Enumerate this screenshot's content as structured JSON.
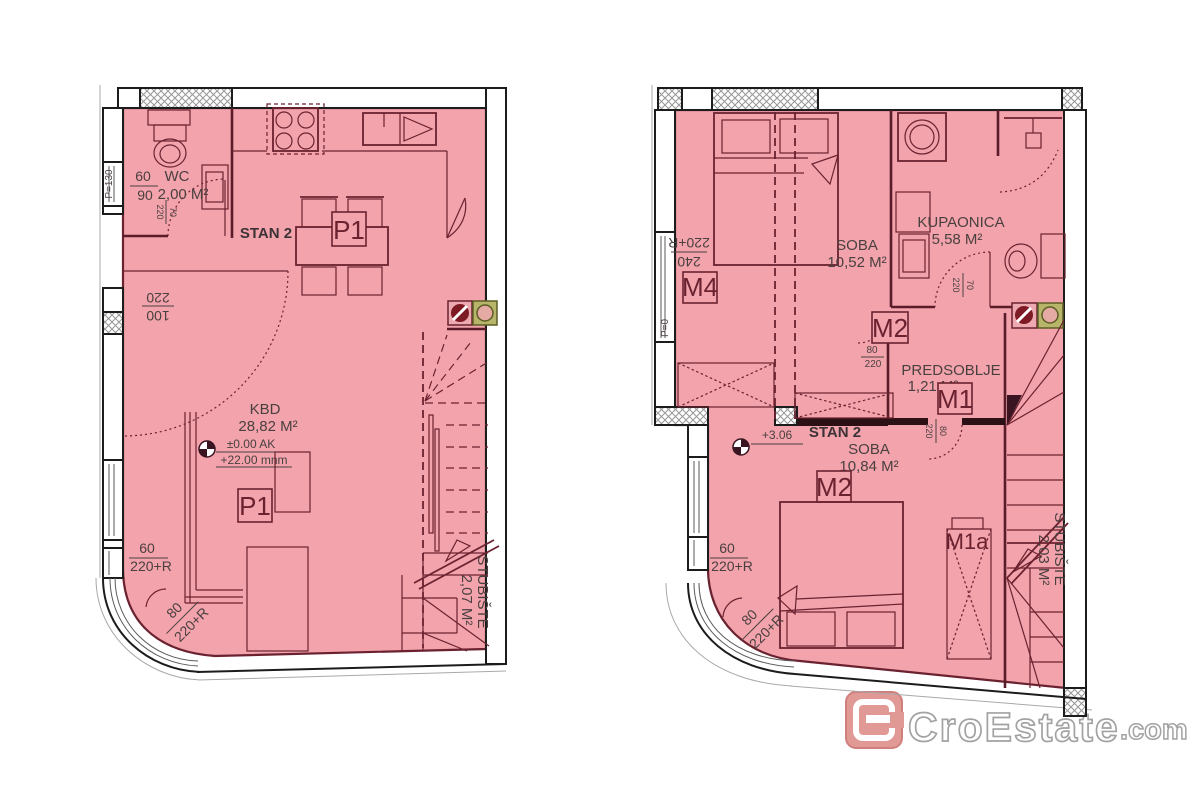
{
  "colors": {
    "plan_fill_pink": "#f2a3ab",
    "plan_line_maroon": "#6b2230",
    "wall_black": "#1c1c1c",
    "annotation_text": "#4a4040",
    "vent_red": "#7e1a24",
    "vent_green_bg": "#b6b56a",
    "logo_red": "#e09490",
    "logo_outline_gray": "#9e9e9e"
  },
  "watermark": {
    "brand": "CroEstate",
    "t": ".com"
  },
  "left": {
    "stan": "STAN 2",
    "wc": {
      "name": "WC",
      "area": "2,00 M²",
      "dim_w": "60",
      "dim_d": "90",
      "door_w": "70",
      "door_h": "220"
    },
    "parapet": "P=130",
    "balcony": {
      "w": "100",
      "h": "220"
    },
    "kbd": {
      "name": "KBD",
      "area": "28,82 M²"
    },
    "level": {
      "rel": "±0.00 AK",
      "abs": "+22.00 mnm"
    },
    "table_label": "P1",
    "sofa_label": "P1",
    "stairs": {
      "name": "STUBIŠTE",
      "area": "2,07 M²"
    },
    "door60": {
      "w": "60",
      "h": "220+R"
    },
    "door80": {
      "w": "80",
      "h": "220+R"
    }
  },
  "right": {
    "stan": "STAN 2",
    "level": "+3.06",
    "parapet": "P=0",
    "soba_upper": {
      "name": "SOBA",
      "area": "10,52 M²"
    },
    "soba_lower": {
      "name": "SOBA",
      "area": "10,84 M²"
    },
    "kupaonica": {
      "name": "KUPAONICA",
      "area": "5,58 M²",
      "door_w": "70",
      "door_h": "220"
    },
    "predsoblje": {
      "name": "PREDSOBLJE",
      "area": "1,21 M²"
    },
    "window240": {
      "w": "240",
      "h": "220+R"
    },
    "m4": "M4",
    "m2_upper": "M2",
    "m2_upper_dims": {
      "w": "80",
      "h": "220"
    },
    "m1": "M1",
    "m1_dims": {
      "w": "80",
      "h": "220"
    },
    "m1a": "M1a",
    "m2_lower": "M2",
    "stairs": {
      "name": "STUBIŠTE",
      "area": "2,03 M²"
    },
    "door60": {
      "w": "60",
      "h": "220+R"
    },
    "door80": {
      "w": "80",
      "h": "220+R"
    }
  }
}
